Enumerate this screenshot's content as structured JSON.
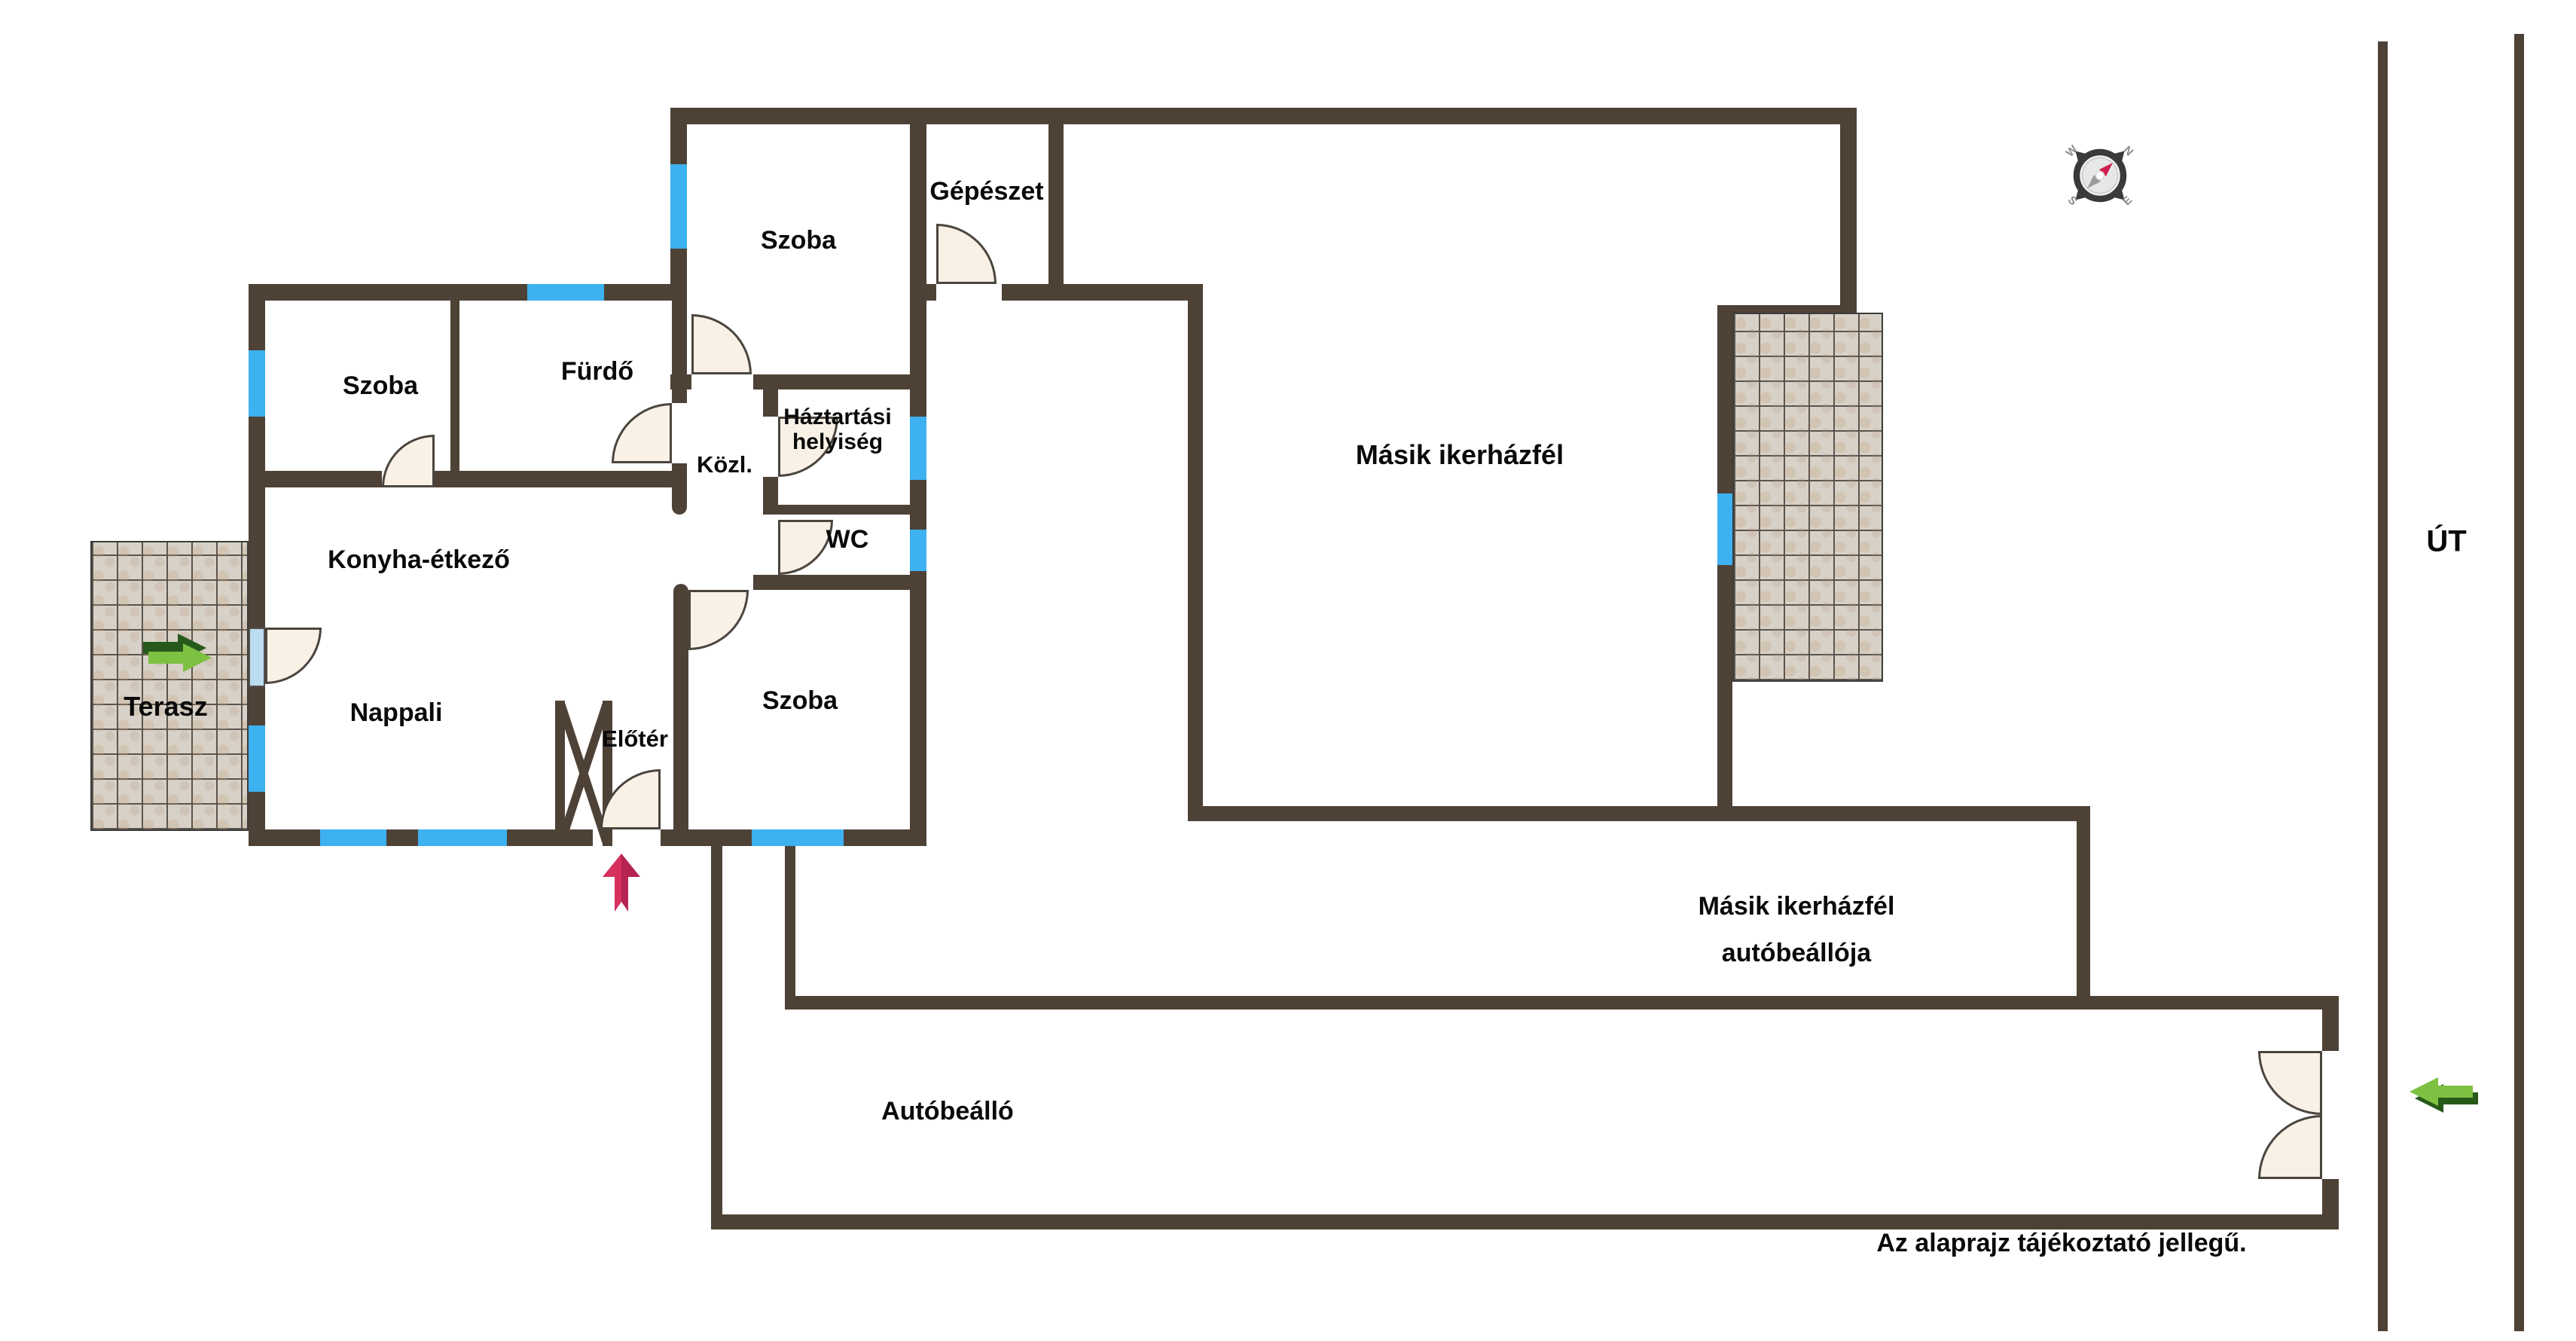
{
  "labels": {
    "szoba_top": "Szoba",
    "gepeszet": "Gépészet",
    "szoba_left": "Szoba",
    "furdo": "Fürdő",
    "kozl": "Közl.",
    "haztartasi": "Háztartási\nhelyiség",
    "wc": "WC",
    "konyha": "Konyha-étkező",
    "nappali": "Nappali",
    "eloter": "Előtér",
    "szoba_bottom": "Szoba",
    "terasz": "Terasz",
    "masik_ikerhazfel": "Másik ikerházfél",
    "masik_carport": "Másik ikerházfél\nautóbeállója",
    "autobeallo": "Autóbeálló",
    "ut": "ÚT",
    "disclaimer": "Az alaprajz tájékoztató jellegű."
  },
  "compass": {
    "n": "N",
    "e": "E",
    "s": "S",
    "w": "W"
  },
  "colors": {
    "wall": "#4e4237",
    "window": "#3eb1f1",
    "door_fill": "#f9f1e6",
    "door_stroke": "#4a453e",
    "tile_bg": "#d8d1c7",
    "tile_line": "#5a544c",
    "arrow_green_light": "#7dc142",
    "arrow_green_dark": "#27591b",
    "arrow_pink": "#d6305f",
    "arrow_pink_dark": "#b52450",
    "text": "#0a0a0a",
    "compass_ring": "#3a3a3a",
    "compass_needle": "#cf1f4e"
  }
}
